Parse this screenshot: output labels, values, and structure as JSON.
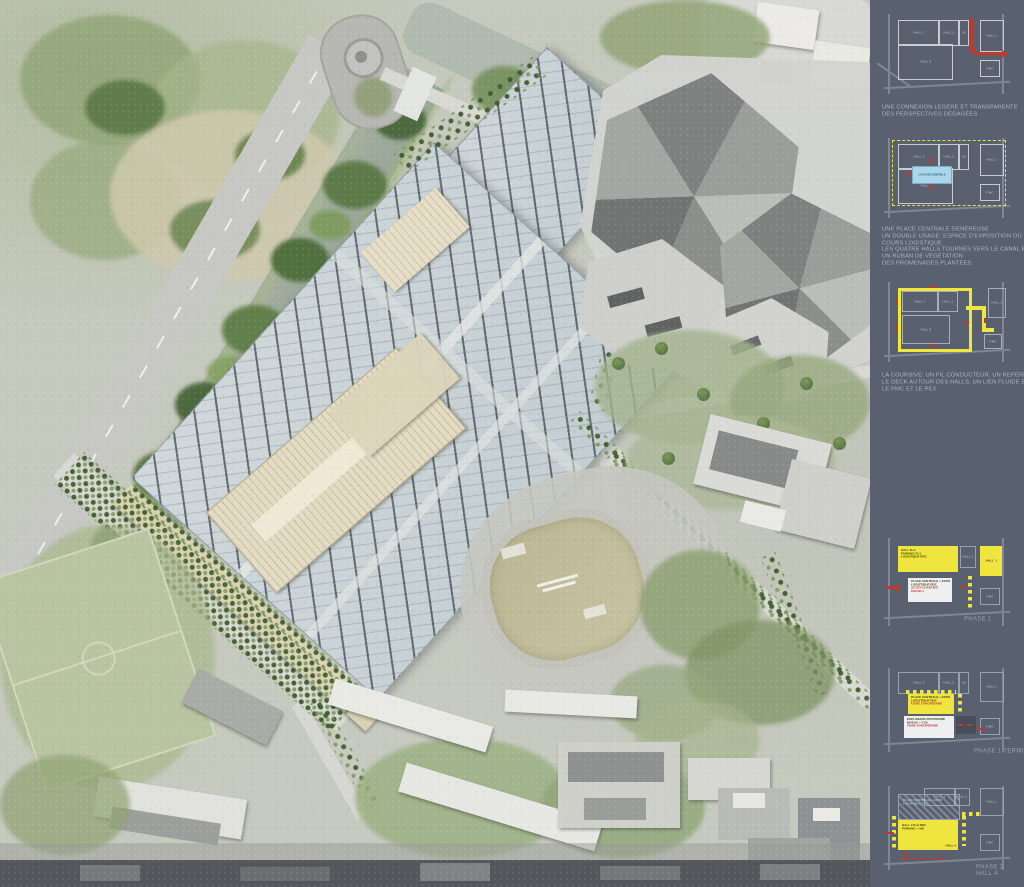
{
  "sidebar": {
    "background": "#596170",
    "halls": {
      "h3": "HALL 3",
      "h2": "HALL 2",
      "a2": "A2",
      "h4": "HALL 4",
      "h1": "HALL 1",
      "pmc": "PMC"
    },
    "panels": [
      {
        "id": "connexion",
        "caption": [
          "UNE CONNEXION LÉGÈRE ET TRANSPARENTE",
          "DES PERSPECTIVES DÉGAGÉES"
        ]
      },
      {
        "id": "place-centrale",
        "place_label": "LA PLACE CENTRALE",
        "caption": [
          "UNE PLACE CENTRALE GÉNÉREUSE",
          "UN DOUBLE USAGE: ESPACE D'EXPOSITION OU",
          "COURS LOGISTIQUE",
          "LES QUATRE HALLS TOURNÉS VERS LE CANAL ET LA VILLE",
          "UN RUBAN DE VÉGÉTATION",
          "DES PROMENADES PLANTÉES"
        ]
      },
      {
        "id": "coursive",
        "caption": [
          "LA COURSIVE: UN FIL CONDUCTEUR, UN REPÈRE",
          "LE DECK AUTOUR DES HALLS, UN LIEN FLUIDE ENTRE",
          "LE PMC ET LE PEX"
        ]
      },
      {
        "id": "phase-1",
        "hall_new": [
          "HALL R+2",
          "PARKING R+1",
          "LOGISTIQUE RDC"
        ],
        "place": [
          "PLACE CENTRALE + EXPO",
          "LOGISTIQUE RDC"
        ],
        "acces": [
          "ACCÈS CHANTIER",
          "PHASE 1"
        ],
        "phase_label": "PHASE 1"
      },
      {
        "id": "phase-1-terminee",
        "place": [
          "PLACE CENTRALE + EXPO",
          "LOGISTIQUE RDC"
        ],
        "place_red": "FOIRE EUROPÉENNE",
        "esplanade": [
          "ESPLANADE PROVISOIRE",
          "NIVEAU + 7,50"
        ],
        "esplanade_red": "FOIRE EUROPÉENNE",
        "phase_label": "PHASE 1 TERMINÉE"
      },
      {
        "id": "phase-2-hall-4",
        "place": [
          "PLACE CENTRALE + EXPO",
          "LOGISTIQUE RDC"
        ],
        "hall4": [
          "HALL 4 R+2 RDC",
          "PARKING + 330"
        ],
        "hall4_label": "HALL 4",
        "phase_label": [
          "PHASE 2",
          "HALL 4"
        ]
      }
    ]
  },
  "palette": {
    "sidebar_background": "#596170",
    "diagram_line": "#c7ccd4",
    "accent_yellow": "#efe53e",
    "accent_red": "#c0392b",
    "place_blue": "#a9d7e9",
    "hall_roof": "#c9d3d7",
    "vegetation": "#5d7a48",
    "beige_building": "#e3dcc2",
    "water": "#a3ae9f"
  }
}
